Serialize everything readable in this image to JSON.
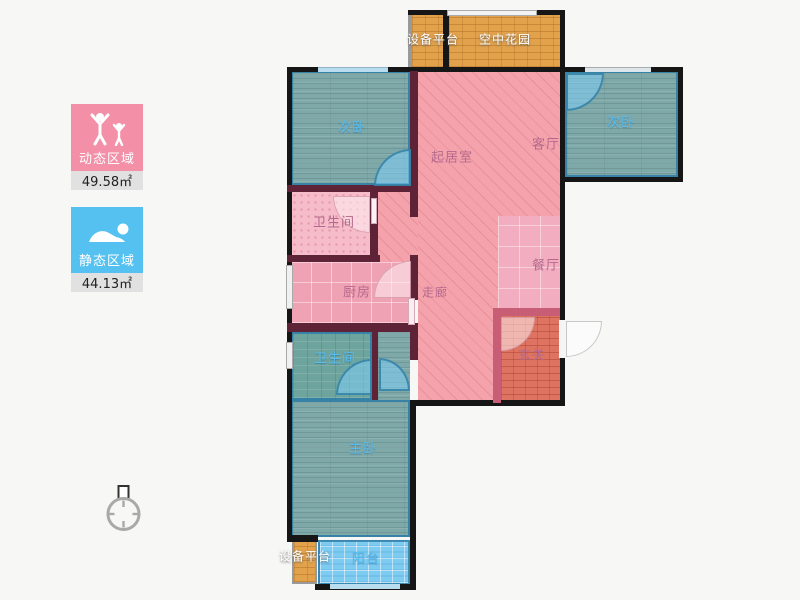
{
  "legend": {
    "dynamic": {
      "label": "动态区域",
      "area": "49.58㎡",
      "color": "#f38fa7",
      "icon": "people-arms-up-icon"
    },
    "static": {
      "label": "静态区域",
      "area": "44.13㎡",
      "color": "#55c1f1",
      "icon": "sleeping-person-icon"
    }
  },
  "plan": {
    "rooms": {
      "bedroom_left": {
        "label": "次卧"
      },
      "living": {
        "label": "起居室"
      },
      "parlor": {
        "label": "客厅"
      },
      "bedroom_right": {
        "label": "次卧"
      },
      "bath_upper": {
        "label": "卫生间"
      },
      "kitchen": {
        "label": "厨房"
      },
      "corridor": {
        "label": "走廊"
      },
      "dining": {
        "label": "餐厅"
      },
      "foyer": {
        "label": "玄关"
      },
      "bath_lower": {
        "label": "卫生间"
      },
      "master": {
        "label": "主卧"
      },
      "balcony": {
        "label": "阳台"
      },
      "equip_top": {
        "label": "设备平台"
      },
      "garden": {
        "label": "空中花园"
      },
      "equip_bottom": {
        "label": "设备平台"
      }
    },
    "colors": {
      "outer_wall": "#161616",
      "inner_wall": "#5e2336",
      "bedroom_floor": "#7fa8a8",
      "living_floor": "#f4a3ac",
      "balcony_floor": "#7ecbf1",
      "garden_floor": "#e2a24c",
      "foyer_floor": "#dd7360"
    }
  }
}
